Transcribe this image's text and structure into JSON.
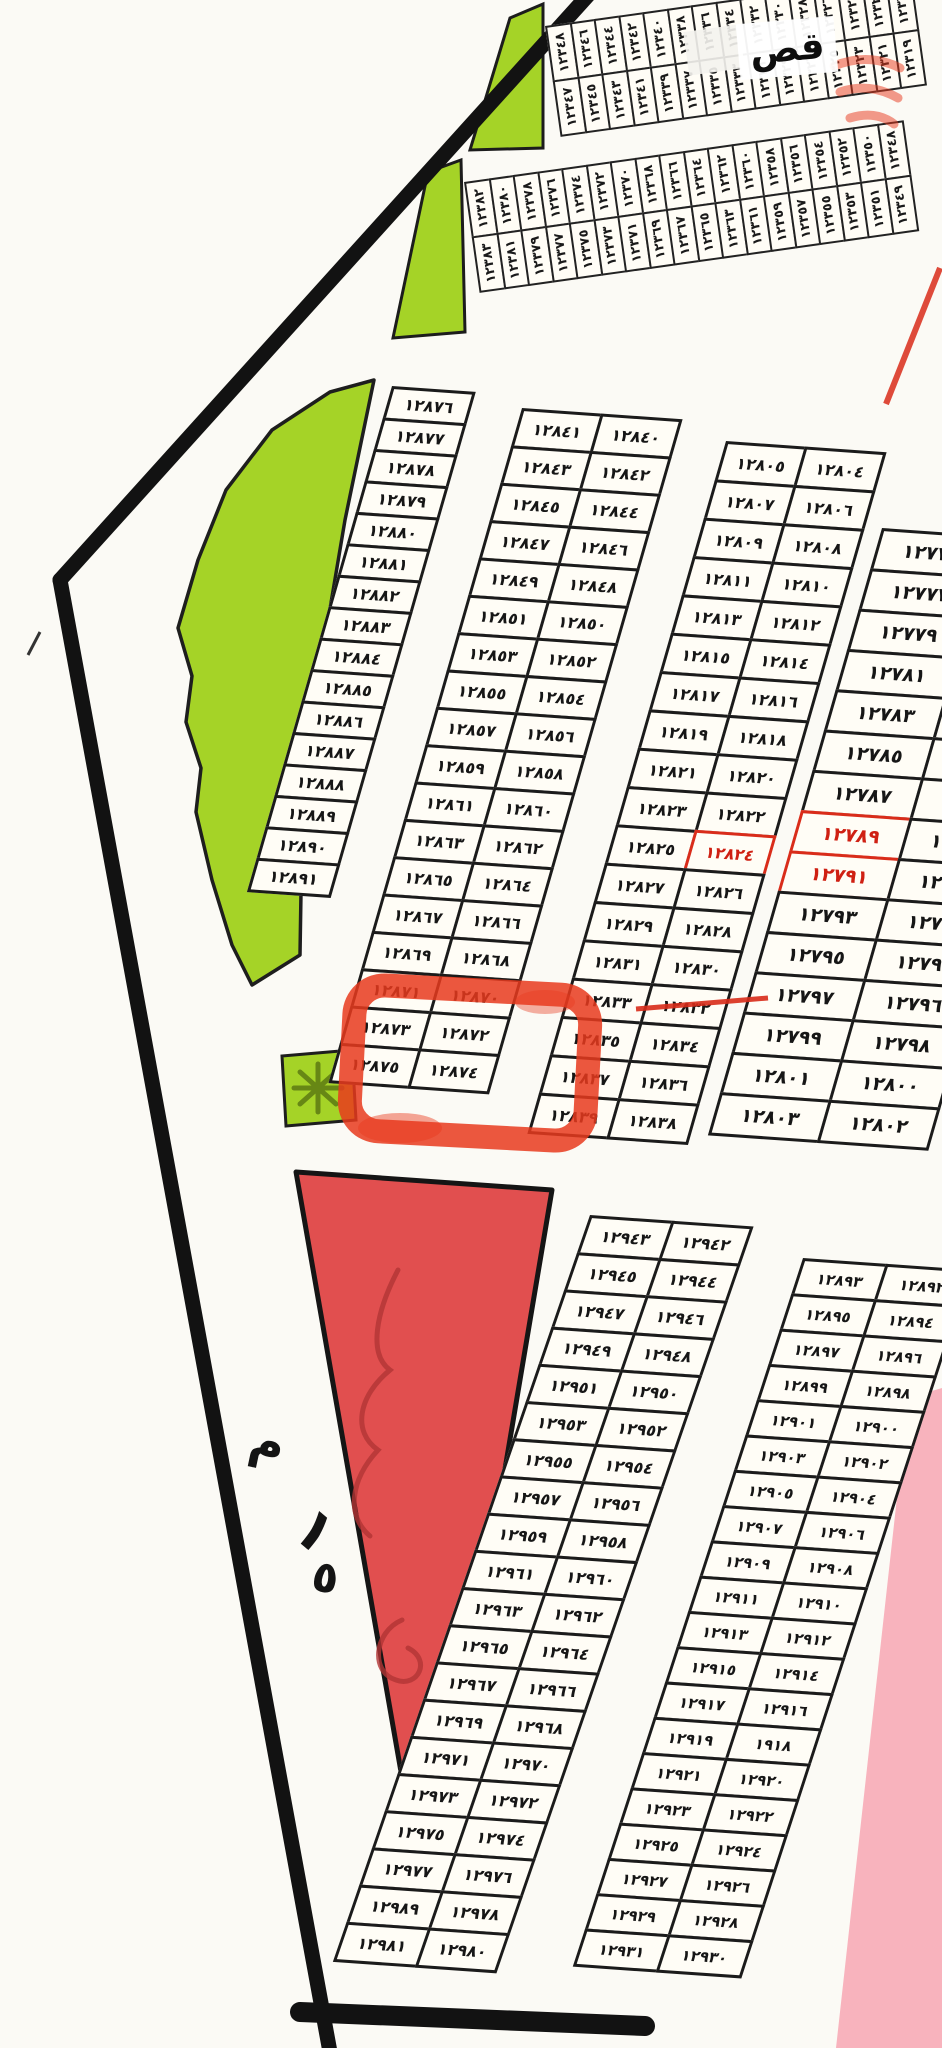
{
  "title": "مخطط أراضي - قطع مرقمة",
  "colors": {
    "park_green": "#a5d327",
    "park_green_dark": "#5d7a12",
    "red_plot": "#e14f4f",
    "red_plot_scribble": "#b23434",
    "marker_red": "#e8391d",
    "red_ink": "#d92c1a",
    "pink_zone": "#f8b3bd",
    "boundary_ink": "#121212"
  },
  "labels": {
    "qas": "قص",
    "width_letter_m": "م",
    "width_digit_1": "١",
    "width_digit_5": "٥"
  },
  "strips": {
    "s1_top": [
      "١٢٣٤٨",
      "١٢٣٤٦",
      "١٢٣٤٤",
      "١٢٣٤٢",
      "١٢٣٤٠",
      "١٢٣٣٨",
      "١٢٣٣٦",
      "١٢٣٣٤",
      "١٢٣٣٢",
      "١٢٣٣٠",
      "١٢٣٢٨",
      "١٢٣٢٦",
      "١٢٣٢٤",
      "١٢٣٢٢",
      "١٢٣٢٠"
    ],
    "s1_bottom": [
      "١٢٣٤٧",
      "١٢٣٤٥",
      "١٢٣٤٣",
      "١٢٣٤١",
      "١٢٣٣٩",
      "١٢٣٣٧",
      "١٢٣٣٥",
      "١٢٣٣٣",
      "١٢٣٣١",
      "١٢٣٢٩",
      "١٢٣٢٧",
      "١٢٣٢٥",
      "١٢٣٢٣",
      "١٢٣٢١",
      "١٢٣١٩"
    ],
    "s2_top": [
      "١٢٣٨٢",
      "١٢٣٨٠",
      "١٢٣٧٨",
      "١٢٣٧٦",
      "١٢٣٧٤",
      "١٢٣٧٢",
      "١٢٣٧٠",
      "١٢٣٦٨",
      "١٢٣٦٦",
      "١٢٣٦٤",
      "١٢٣٦٢",
      "١٢٣٦٠",
      "١٢٣٥٨",
      "١٢٣٥٦",
      "١٢٣٥٤",
      "١٢٣٥٢",
      "١٢٣٥٠",
      "١٢٣٤٨"
    ],
    "s2_bottom": [
      "١٢٣٨٣",
      "١٢٣٨١",
      "١٢٣٧٩",
      "١٢٣٧٧",
      "١٢٣٧٥",
      "١٢٣٧٣",
      "١٢٣٧١",
      "١٢٣٦٩",
      "١٢٣٦٧",
      "١٢٣٦٥",
      "١٢٣٦٣",
      "١٢٣٦١",
      "١٢٣٥٩",
      "١٢٣٥٧",
      "١٢٣٥٥",
      "١٢٣٥٣",
      "١٢٣٥١",
      "١٢٣٤٩"
    ]
  },
  "blocks": {
    "A": {
      "rows": [
        {
          "l": "١٢٨٧٦"
        },
        {
          "l": "١٢٨٧٧"
        },
        {
          "l": "١٢٨٧٨"
        },
        {
          "l": "١٢٨٧٩"
        },
        {
          "l": "١٢٨٨٠"
        },
        {
          "l": "١٢٨٨١"
        },
        {
          "l": "١٢٨٨٢"
        },
        {
          "l": "١٢٨٨٣"
        },
        {
          "l": "١٢٨٨٤"
        },
        {
          "l": "١٢٨٨٥"
        },
        {
          "l": "١٢٨٨٦"
        },
        {
          "l": "١٢٨٨٧"
        },
        {
          "l": "١٢٨٨٨"
        },
        {
          "l": "١٢٨٨٩"
        },
        {
          "l": "١٢٨٩٠"
        },
        {
          "l": "١٢٨٩١"
        }
      ]
    },
    "B": {
      "rows": [
        {
          "l": "١٢٨٤١",
          "r": "١٢٨٤٠"
        },
        {
          "l": "١٢٨٤٣",
          "r": "١٢٨٤٢"
        },
        {
          "l": "١٢٨٤٥",
          "r": "١٢٨٤٤"
        },
        {
          "l": "١٢٨٤٧",
          "r": "١٢٨٤٦"
        },
        {
          "l": "١٢٨٤٩",
          "r": "١٢٨٤٨"
        },
        {
          "l": "١٢٨٥١",
          "r": "١٢٨٥٠"
        },
        {
          "l": "١٢٨٥٣",
          "r": "١٢٨٥٢"
        },
        {
          "l": "١٢٨٥٥",
          "r": "١٢٨٥٤"
        },
        {
          "l": "١٢٨٥٧",
          "r": "١٢٨٥٦"
        },
        {
          "l": "١٢٨٥٩",
          "r": "١٢٨٥٨"
        },
        {
          "l": "١٢٨٦١",
          "r": "١٢٨٦٠"
        },
        {
          "l": "١٢٨٦٣",
          "r": "١٢٨٦٢"
        },
        {
          "l": "١٢٨٦٥",
          "r": "١٢٨٦٤"
        },
        {
          "l": "١٢٨٦٧",
          "r": "١٢٨٦٦"
        },
        {
          "l": "١٢٨٦٩",
          "r": "١٢٨٦٨"
        },
        {
          "l": "١٢٨٧١",
          "r": "١٢٨٧٠"
        },
        {
          "l": "١٢٨٧٣",
          "r": "١٢٨٧٢"
        },
        {
          "l": "١٢٨٧٥",
          "r": "١٢٨٧٤"
        }
      ]
    },
    "C": {
      "rows": [
        {
          "l": "١٢٨٠٥",
          "r": "١٢٨٠٤"
        },
        {
          "l": "١٢٨٠٧",
          "r": "١٢٨٠٦"
        },
        {
          "l": "١٢٨٠٩",
          "r": "١٢٨٠٨"
        },
        {
          "l": "١٢٨١١",
          "r": "١٢٨١٠"
        },
        {
          "l": "١٢٨١٣",
          "r": "١٢٨١٢"
        },
        {
          "l": "١٢٨١٥",
          "r": "١٢٨١٤"
        },
        {
          "l": "١٢٨١٧",
          "r": "١٢٨١٦"
        },
        {
          "l": "١٢٨١٩",
          "r": "١٢٨١٨"
        },
        {
          "l": "١٢٨٢١",
          "r": "١٢٨٢٠"
        },
        {
          "l": "١٢٨٢٣",
          "r": "١٢٨٢٢"
        },
        {
          "l": "١٢٨٢٥",
          "r": "١٢٨٢٤",
          "rv": "red"
        },
        {
          "l": "١٢٨٢٧",
          "r": "١٢٨٢٦"
        },
        {
          "l": "١٢٨٢٩",
          "r": "١٢٨٢٨"
        },
        {
          "l": "١٢٨٣١",
          "r": "١٢٨٣٠"
        },
        {
          "l": "١٢٨٣٣",
          "r": "١٢٨٣٢"
        },
        {
          "l": "١٢٨٣٥",
          "r": "١٢٨٣٤"
        },
        {
          "l": "١٢٨٣٧",
          "r": "١٢٨٣٦"
        },
        {
          "l": "١٢٨٣٩",
          "r": "١٢٨٣٨"
        }
      ]
    },
    "D": {
      "rows": [
        {
          "l": "١٢٧٧٥",
          "r": "١٢٧٧٤"
        },
        {
          "l": "١٢٧٧٧",
          "r": "١٢٧٧٦"
        },
        {
          "l": "١٢٧٧٩",
          "r": "١٢٧٧٨"
        },
        {
          "l": "١٢٧٨١",
          "r": "١٢٧٨٠"
        },
        {
          "l": "١٢٧٨٣",
          "r": "١٢٧٨٢"
        },
        {
          "l": "١٢٧٨٥",
          "r": "١٢٧٨٤"
        },
        {
          "l": "١٢٧٨٧",
          "r": "١٢٧٨٦"
        },
        {
          "l": "١٢٧٨٩",
          "r": "١٢٧٨٨",
          "lv": "red"
        },
        {
          "l": "١٢٧٩١",
          "r": "١٢٧٩٠",
          "lv": "red"
        },
        {
          "l": "١٢٧٩٣",
          "r": "١٢٧٩٢"
        },
        {
          "l": "١٢٧٩٥",
          "r": "١٢٧٩٤"
        },
        {
          "l": "١٢٧٩٧",
          "r": "١٢٧٩٦"
        },
        {
          "l": "١٢٧٩٩",
          "r": "١٢٧٩٨"
        },
        {
          "l": "١٢٨٠١",
          "r": "١٢٨٠٠"
        },
        {
          "l": "١٢٨٠٣",
          "r": "١٢٨٠٢"
        }
      ]
    },
    "E": {
      "rows": [
        {
          "l": "١٢٩٤٣",
          "r": "١٢٩٤٢"
        },
        {
          "l": "١٢٩٤٥",
          "r": "١٢٩٤٤"
        },
        {
          "l": "١٢٩٤٧",
          "r": "١٢٩٤٦"
        },
        {
          "l": "١٢٩٤٩",
          "r": "١٢٩٤٨"
        },
        {
          "l": "١٢٩٥١",
          "r": "١٢٩٥٠"
        },
        {
          "l": "١٢٩٥٣",
          "r": "١٢٩٥٢"
        },
        {
          "l": "١٢٩٥٥",
          "r": "١٢٩٥٤"
        },
        {
          "l": "١٢٩٥٧",
          "r": "١٢٩٥٦"
        },
        {
          "l": "١٢٩٥٩",
          "r": "١٢٩٥٨"
        },
        {
          "l": "١٢٩٦١",
          "r": "١٢٩٦٠"
        },
        {
          "l": "١٢٩٦٣",
          "r": "١٢٩٦٢"
        },
        {
          "l": "١٢٩٦٥",
          "r": "١٢٩٦٤"
        },
        {
          "l": "١٢٩٦٧",
          "r": "١٢٩٦٦"
        },
        {
          "l": "١٢٩٦٩",
          "r": "١٢٩٦٨"
        },
        {
          "l": "١٢٩٧١",
          "r": "١٢٩٧٠"
        },
        {
          "l": "١٢٩٧٣",
          "r": "١٢٩٧٢"
        },
        {
          "l": "١٢٩٧٥",
          "r": "١٢٩٧٤"
        },
        {
          "l": "١٢٩٧٧",
          "r": "١٢٩٧٦"
        },
        {
          "l": "١٢٩٨٩",
          "r": "١٢٩٧٨"
        },
        {
          "l": "١٢٩٨١",
          "r": "١٢٩٨٠"
        }
      ]
    },
    "F": {
      "rows": [
        {
          "l": "١٢٨٩٣",
          "r": "١٢٨٩٢"
        },
        {
          "l": "١٢٨٩٥",
          "r": "١٢٨٩٤"
        },
        {
          "l": "١٢٨٩٧",
          "r": "١٢٨٩٦"
        },
        {
          "l": "١٢٨٩٩",
          "r": "١٢٨٩٨"
        },
        {
          "l": "١٢٩٠١",
          "r": "١٢٩٠٠"
        },
        {
          "l": "١٢٩٠٣",
          "r": "١٢٩٠٢"
        },
        {
          "l": "١٢٩٠٥",
          "r": "١٢٩٠٤"
        },
        {
          "l": "١٢٩٠٧",
          "r": "١٢٩٠٦"
        },
        {
          "l": "١٢٩٠٩",
          "r": "١٢٩٠٨"
        },
        {
          "l": "١٢٩١١",
          "r": "١٢٩١٠"
        },
        {
          "l": "١٢٩١٣",
          "r": "١٢٩١٢"
        },
        {
          "l": "١٢٩١٥",
          "r": "١٢٩١٤"
        },
        {
          "l": "١٢٩١٧",
          "r": "١٢٩١٦"
        },
        {
          "l": "١٢٩١٩",
          "r": "١٩١٨"
        },
        {
          "l": "١٢٩٢١",
          "r": "١٢٩٢٠"
        },
        {
          "l": "١٢٩٢٣",
          "r": "١٢٩٢٢"
        },
        {
          "l": "١٢٩٢٥",
          "r": "١٢٩٢٤"
        },
        {
          "l": "١٢٩٢٧",
          "r": "١٢٩٢٦"
        },
        {
          "l": "١٢٩٢٩",
          "r": "١٢٩٢٨"
        },
        {
          "l": "١٢٩٣١",
          "r": "١٢٩٣٠"
        }
      ]
    }
  }
}
